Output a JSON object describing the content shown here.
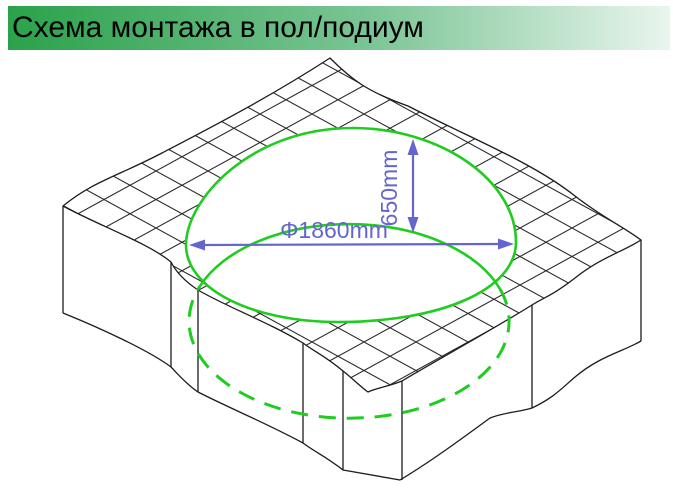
{
  "header": {
    "title": "Схема монтажа в пол/подиум"
  },
  "diagram": {
    "dimensions": {
      "diameter": "Φ1860mm",
      "offset": "650mm"
    },
    "colors": {
      "header_green_left": "#2aa24a",
      "header_green_mid": "#7cc596",
      "header_green_right": "#e9f5ed",
      "circle_green": "#1fcc1f",
      "dimension_blue": "#6466cd",
      "line_black": "#1c1c1c",
      "background": "#ffffff"
    }
  }
}
